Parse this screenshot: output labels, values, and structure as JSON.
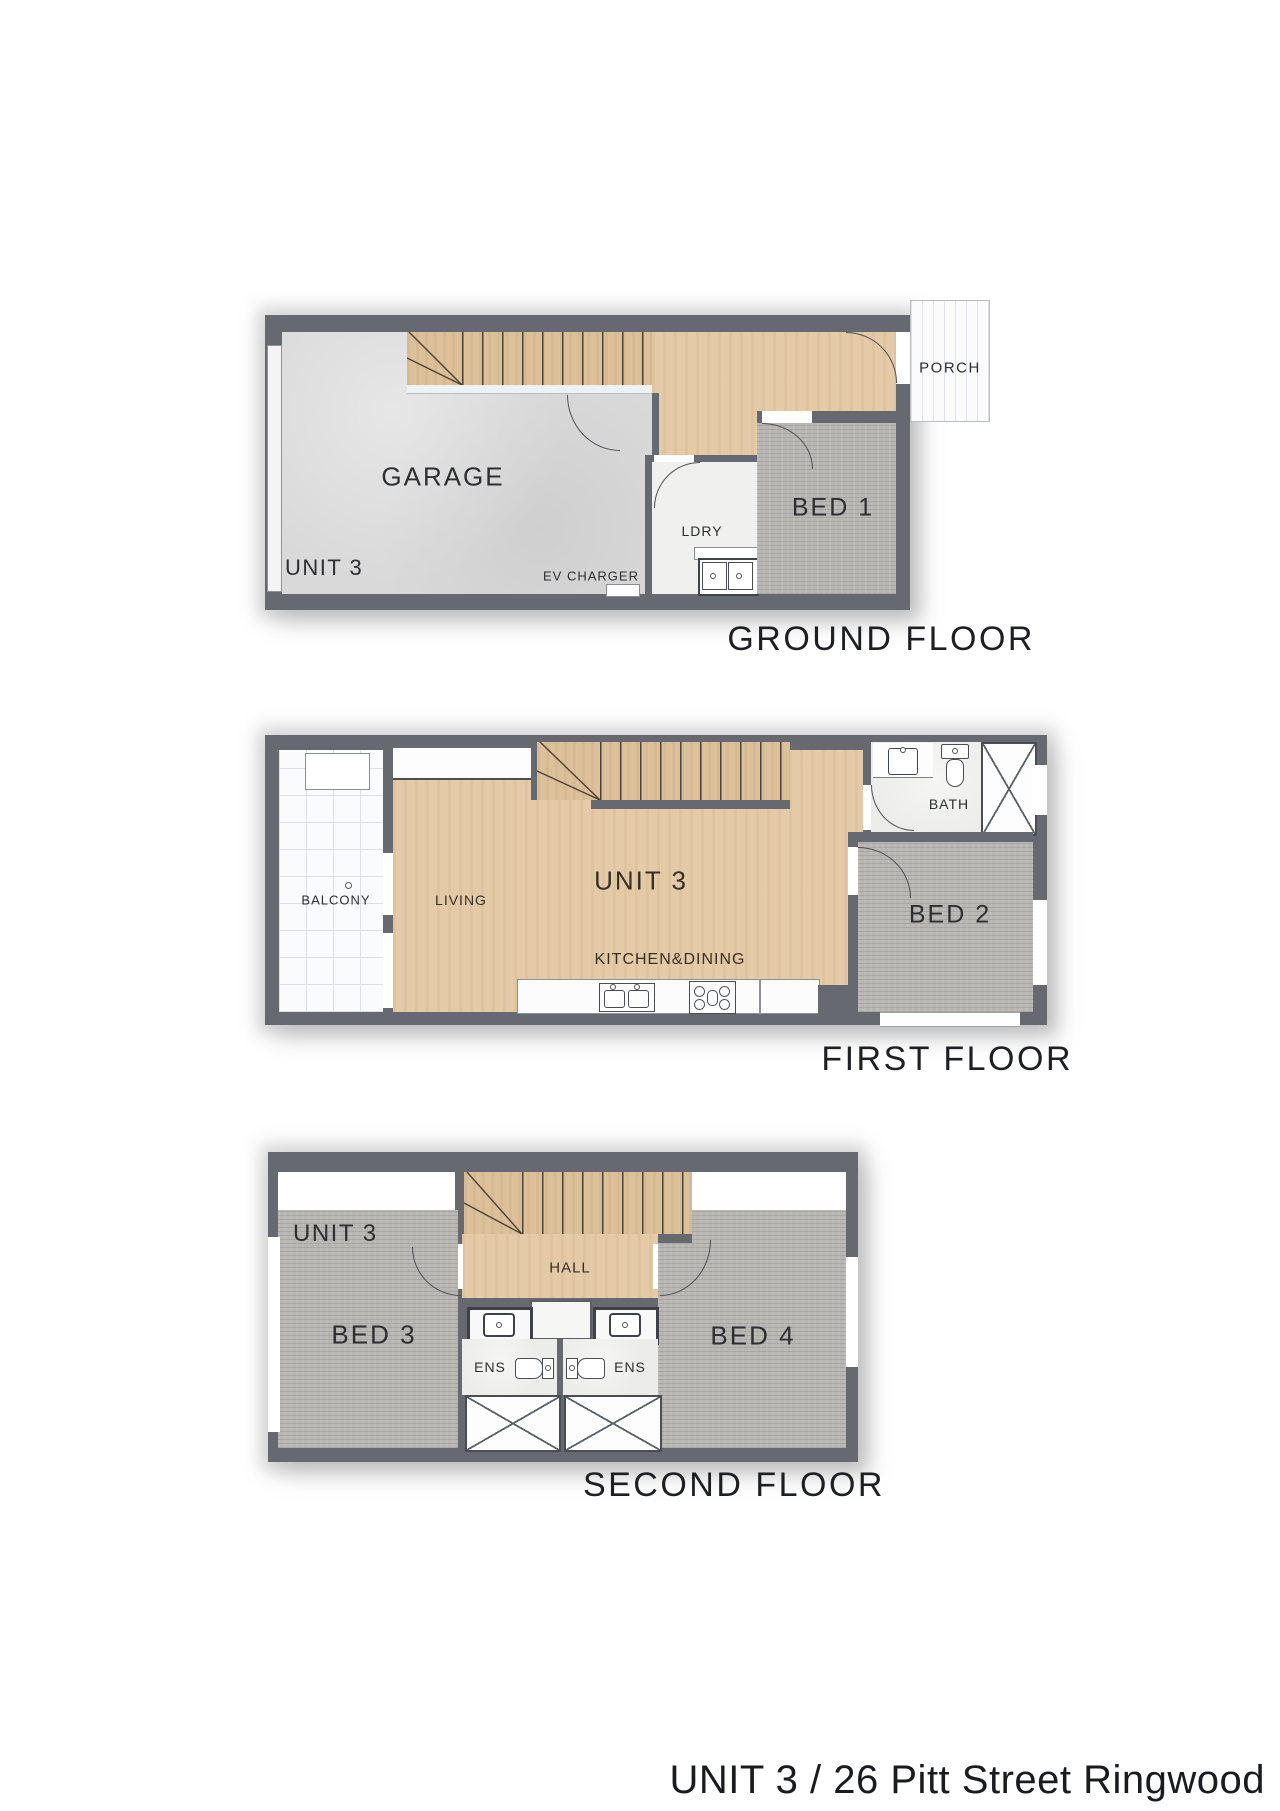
{
  "title": {
    "text": "UNIT 3 / 26 Pitt Street Ringwood"
  },
  "colors": {
    "wall": "#666a70",
    "wood_floor": "#e4caa6",
    "stair_wood": "#dcc09a",
    "carpet": "#b8b6b3",
    "concrete": "#d9d9d9",
    "tile_line": "#dde1e5",
    "label_text": "#1d1f23"
  },
  "floors": [
    {
      "name": "GROUND FLOOR",
      "unit": "UNIT 3",
      "rooms": {
        "garage": "GARAGE",
        "laundry": "LDRY",
        "bed1": "BED 1",
        "porch": "PORCH"
      },
      "notes": {
        "ev_charger": "EV CHARGER"
      }
    },
    {
      "name": "FIRST FLOOR",
      "unit": "UNIT 3",
      "rooms": {
        "balcony": "BALCONY",
        "living": "LIVING",
        "kitchen_dining": "KITCHEN&DINING",
        "bath": "BATH",
        "bed2": "BED 2"
      }
    },
    {
      "name": "SECOND FLOOR",
      "unit": "UNIT 3",
      "rooms": {
        "bed3": "BED 3",
        "hall": "HALL",
        "ens1": "ENS",
        "ens2": "ENS",
        "bed4": "BED 4"
      }
    }
  ]
}
